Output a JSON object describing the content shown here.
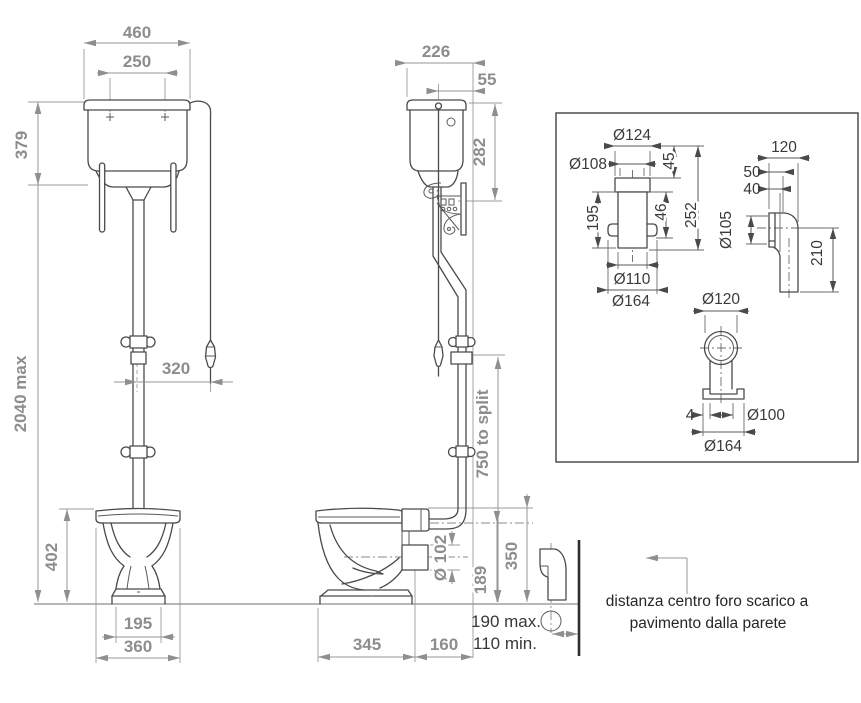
{
  "front_view": {
    "width": "460",
    "fixing_centres": "250",
    "cistern_height": "379",
    "total_height": "2040 max",
    "chain_offset": "320",
    "bowl_height": "402",
    "base_width": "195",
    "bowl_width": "360"
  },
  "side_view": {
    "cistern_depth": "226",
    "pull_offset": "55",
    "cistern_side_height": "282",
    "split_height": "750 to split",
    "outlet_diameter": "Ø 102",
    "outlet_centre_height": "189",
    "rim_height": "350",
    "bowl_depth": "345",
    "outlet_projection": "160",
    "drain_distance_max": "190 max.",
    "drain_distance_min": "110 min."
  },
  "detail_box": {
    "connector": {
      "collar_diameter": "Ø124",
      "inner_diameter": "Ø108",
      "collar_height": "45",
      "lug_offset": "46",
      "total_length": "252",
      "body_length": "195",
      "pipe_diameter": "Ø110",
      "flange_diameter": "Ø164"
    },
    "elbow": {
      "width": "120",
      "top_offset": "50",
      "mid_offset": "40",
      "inlet_diameter": "Ø105",
      "height": "210"
    },
    "floor_outlet": {
      "ring_diameter": "Ø120",
      "lip": "4",
      "pipe_diameter": "Ø100",
      "flange_diameter": "Ø164"
    }
  },
  "caption": {
    "line1": "distanza centro foro scarico a",
    "line2": "pavimento dalla parete"
  },
  "colors": {
    "line": "#4a4a4a",
    "dim": "#8d8d8d",
    "dark_text": "#3a3a3a"
  }
}
